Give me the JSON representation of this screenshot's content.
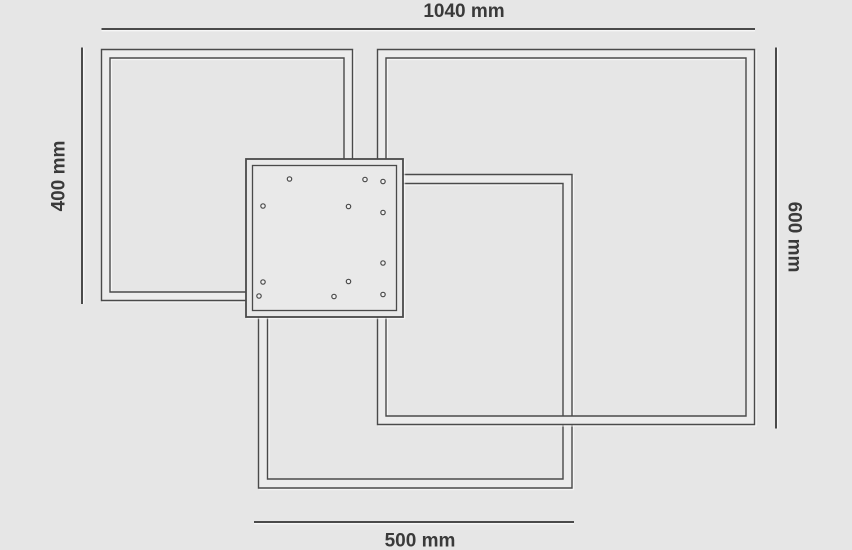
{
  "page": {
    "background": "#e6e6e6"
  },
  "colors": {
    "line": "#4a4a4a",
    "bar_fill": "#ececec",
    "plate_fill": "#e9e9e9",
    "hole_fill": "#f1f1f1",
    "text": "#3a3a3a",
    "highlight": "#ffffff"
  },
  "dimension_labels": {
    "top": "1040 mm",
    "left": "400 mm",
    "right": "600 mm",
    "bottom": "500 mm"
  },
  "diagram": {
    "canvas": {
      "width": 852,
      "height": 550
    },
    "frames": [
      {
        "id": "frame-500mm",
        "outer": [
          258.5,
          174.5,
          313.5,
          313.5
        ],
        "inset": 9
      },
      {
        "id": "frame-600mm",
        "outer": [
          377.5,
          49.5,
          377,
          375
        ],
        "inset": 8.5
      },
      {
        "id": "frame-400mm",
        "outer": [
          101.5,
          49.5,
          251,
          251
        ],
        "inset": 8.5
      }
    ],
    "plate": {
      "outer": [
        246,
        159,
        157,
        158
      ],
      "inner_inset": 6.5,
      "hole_radius": 2.2,
      "holes": [
        [
          289.5,
          179
        ],
        [
          365,
          179.5
        ],
        [
          383,
          181.5
        ],
        [
          263,
          206
        ],
        [
          348.5,
          206.5
        ],
        [
          383,
          212.5
        ],
        [
          383,
          263
        ],
        [
          263,
          282
        ],
        [
          348.5,
          281.5
        ],
        [
          259,
          296
        ],
        [
          334,
          296.5
        ],
        [
          383,
          294.5
        ]
      ]
    },
    "dimension_lines": {
      "top": {
        "x1": 101.5,
        "y1": 29,
        "x2": 755,
        "y2": 29
      },
      "left": {
        "x1": 82,
        "y1": 47.5,
        "x2": 82,
        "y2": 304
      },
      "right": {
        "x1": 776,
        "y1": 47.5,
        "x2": 776,
        "y2": 428.5
      },
      "bottom": {
        "x1": 254,
        "y1": 522,
        "x2": 574,
        "y2": 522
      }
    },
    "label_anchors": {
      "top": {
        "x": 464,
        "y": 17,
        "rotate": 0
      },
      "left": {
        "x": 59,
        "y": 176,
        "rotate": -90
      },
      "right": {
        "x": 794,
        "y": 237,
        "rotate": 90
      },
      "bottom": {
        "x": 420,
        "y": 546.5,
        "rotate": 0
      }
    }
  }
}
